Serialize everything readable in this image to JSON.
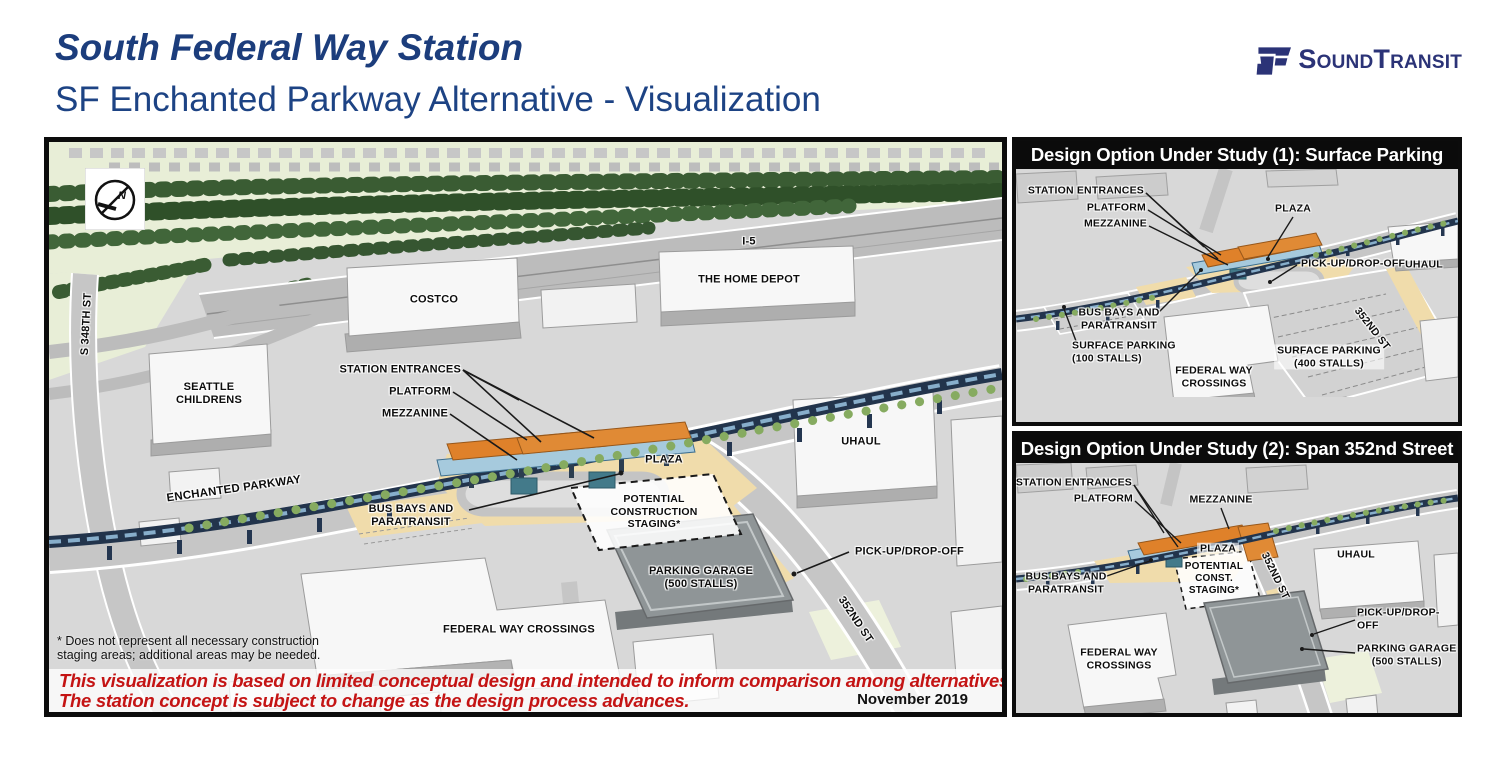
{
  "header": {
    "title": "South Federal Way Station",
    "subtitle": "SF Enchanted Parkway Alternative - Visualization"
  },
  "logo": {
    "sound": "SOUND",
    "transit": "TRANSIT"
  },
  "colors": {
    "title_blue": "#1c3d7c",
    "logo_navy": "#2b3377",
    "disclaimer_red": "#c41414",
    "panel_header_bg": "#0b0b0b",
    "panel_header_text": "#ffffff",
    "map_ground": "#d8d8d8",
    "green_area": "#e8eed7",
    "tree_green": "#3a5c33",
    "road_gray": "#c6c6c6",
    "building_white": "#f7f7f7",
    "garage_gray": "#8f9597",
    "plaza_tan": "#f0dcab",
    "guideway_navy": "#22344c",
    "station_orange": "#df812a",
    "station_glass": "#a6cadd"
  },
  "main_map": {
    "compass": "N",
    "labels": {
      "i5": "I-5",
      "costco": "COSTCO",
      "home_depot": "THE HOME DEPOT",
      "s_348th_st": "S 348TH ST",
      "seattle_childrens": "SEATTLE\nCHILDRENS",
      "station_entrances": "STATION ENTRANCES",
      "platform": "PLATFORM",
      "mezzanine": "MEZZANINE",
      "enchanted_parkway": "ENCHANTED PARKWAY",
      "bus_bays": "BUS BAYS AND\nPARATRANSIT",
      "plaza": "PLAZA",
      "staging": "POTENTIAL\nCONSTRUCTION\nSTAGING*",
      "parking_garage": "PARKING GARAGE\n(500 STALLS)",
      "uhaul": "UHAUL",
      "pickup_dropoff": "PICK-UP/DROP-OFF",
      "st_352nd": "352ND ST",
      "federal_way_crossings": "FEDERAL WAY CROSSINGS"
    },
    "footnote": "* Does not represent all necessary construction\nstaging areas; additional areas may be needed.",
    "disclaimer1": "This visualization is based on limited conceptual design and intended to inform comparison among alternatives.",
    "disclaimer2": "The station concept is subject to change as the design process advances.",
    "date": "November 2019"
  },
  "option1": {
    "header": "Design Option Under Study (1): Surface Parking",
    "labels": {
      "station_entrances": "STATION ENTRANCES",
      "platform": "PLATFORM",
      "mezzanine": "MEZZANINE",
      "plaza": "PLAZA",
      "pickup_dropoff": "PICK-UP/DROP-OFF",
      "uhaul": "UHAUL",
      "bus_bays": "BUS BAYS AND\nPARATRANSIT",
      "surface_parking_100": "SURFACE PARKING\n(100 STALLS)",
      "surface_parking_400": "SURFACE PARKING\n(400 STALLS)",
      "st_352nd": "352ND ST",
      "federal_way_crossings": "FEDERAL WAY\nCROSSINGS"
    }
  },
  "option2": {
    "header": "Design Option Under Study (2): Span 352nd Street",
    "labels": {
      "station_entrances": "STATION ENTRANCES",
      "platform": "PLATFORM",
      "mezzanine": "MEZZANINE",
      "plaza": "PLAZA",
      "staging": "POTENTIAL\nCONST.\nSTAGING*",
      "bus_bays": "BUS BAYS AND\nPARATRANSIT",
      "uhaul": "UHAUL",
      "st_352nd": "352ND ST",
      "pickup_dropoff": "PICK-UP/DROP-OFF",
      "parking_garage": "PARKING GARAGE\n(500 STALLS)",
      "federal_way_crossings": "FEDERAL WAY\nCROSSINGS"
    }
  }
}
